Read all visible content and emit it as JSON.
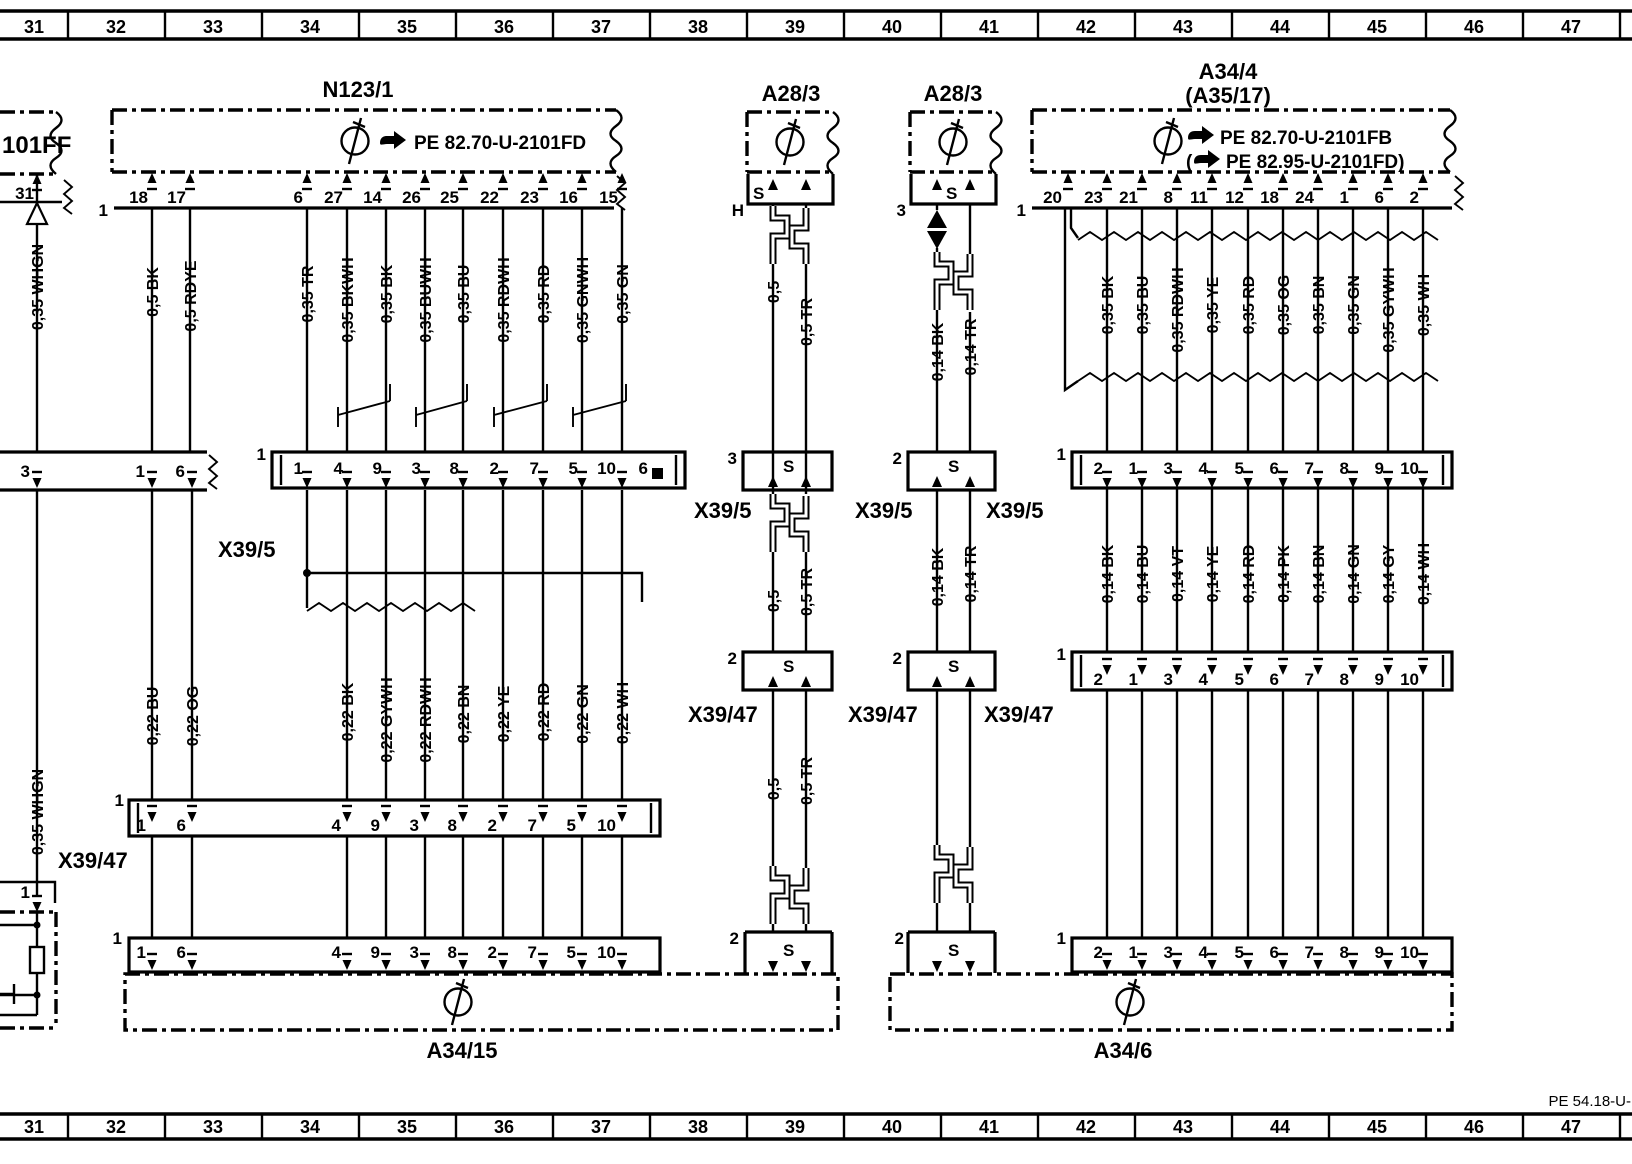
{
  "ruler": [
    "31",
    "32",
    "33",
    "34",
    "35",
    "36",
    "37",
    "38",
    "39",
    "40",
    "41",
    "42",
    "43",
    "44",
    "45",
    "46",
    "47"
  ],
  "footer": "PE 54.18-U-",
  "left": {
    "ref": "101FF",
    "pin31": "31",
    "wire_top": "0,35 WHGN",
    "strip_pins": [
      "3",
      "1",
      "6"
    ],
    "wire_bottom": "0,35 WHGN",
    "pin1": "1"
  },
  "n123": {
    "title": "N123/1",
    "ref": "PE 82.70-U-2101FD",
    "row": "1",
    "pins": [
      "18",
      "17",
      "6",
      "27",
      "14",
      "26",
      "25",
      "22",
      "23",
      "16",
      "15"
    ],
    "wires": [
      "0,5 BK",
      "0,5 RDYE",
      "0,35 TR",
      "0,35 BKWH",
      "0,35 BK",
      "0,35 BUWH",
      "0,35 BU",
      "0,35 RDWH",
      "0,35 RD",
      "0,35 GNWH",
      "0,35 GN"
    ]
  },
  "x5l": {
    "label": "X39/5",
    "row": "1",
    "pins": [
      "1",
      "4",
      "9",
      "3",
      "8",
      "2",
      "7",
      "5",
      "10",
      "6"
    ]
  },
  "w22": [
    "0,22 BU",
    "0,22 OG",
    "0,22 BK",
    "0,22 GYWH",
    "0,22 RDWH",
    "0,22 BN",
    "0,22 YE",
    "0,22 RD",
    "0,22 GN",
    "0,22 WH"
  ],
  "x47l": {
    "label": "X39/47",
    "row": "1",
    "pins": [
      "1",
      "6",
      "4",
      "9",
      "3",
      "8",
      "2",
      "7",
      "5",
      "10"
    ]
  },
  "a3415": {
    "row": "1",
    "pins": [
      "1",
      "6",
      "4",
      "9",
      "3",
      "8",
      "2",
      "7",
      "5",
      "10"
    ],
    "label": "A34/15"
  },
  "ca": {
    "title": "A28/3",
    "h": "H",
    "s": "S",
    "x5_row": "3",
    "x5": "X39/5",
    "x47_row": "2",
    "x47": "X39/47",
    "bottom_row": "2",
    "w1": [
      "0,5",
      "0,5 TR"
    ],
    "w2": [
      "0,5",
      "0,5 TR"
    ],
    "w3": [
      "0,5",
      "0,5 TR"
    ]
  },
  "cb": {
    "title": "A28/3",
    "s": "S",
    "top_row": "3",
    "x5_row": "2",
    "x5": "X39/5",
    "x47_row": "2",
    "x47": "X39/47",
    "bottom_row": "2",
    "w1": [
      "0,14 BK",
      "0,14 TR"
    ],
    "w2": [
      "0,14 BK",
      "0,14 TR"
    ]
  },
  "a344": {
    "title": "A34/4",
    "subtitle": "(A35/17)",
    "ref1": "PE 82.70-U-2101FB",
    "ref2_open": "(",
    "ref2": "PE 82.95-U-2101FD)",
    "row": "1",
    "pins": [
      "20",
      "23",
      "21",
      "8",
      "11",
      "12",
      "18",
      "24",
      "1",
      "6",
      "2"
    ],
    "wires": [
      "0,35 BK",
      "0,35 BU",
      "0,35 RDWH",
      "0,35 YE",
      "0,35 RD",
      "0,35 OG",
      "0,35 BN",
      "0,35 GN",
      "0,35 GYWH",
      "0,35 WH"
    ]
  },
  "x5r": {
    "label": "X39/5",
    "row": "1",
    "pins": [
      "2",
      "1",
      "3",
      "4",
      "5",
      "6",
      "7",
      "8",
      "9",
      "10"
    ]
  },
  "w14": [
    "0,14 BK",
    "0,14 BU",
    "0,14 VT",
    "0,14 YE",
    "0,14 RD",
    "0,14 PK",
    "0,14 BN",
    "0,14 GN",
    "0,14 GY",
    "0,14 WH"
  ],
  "x47r": {
    "label": "X39/47",
    "row": "1",
    "pins": [
      "2",
      "1",
      "3",
      "4",
      "5",
      "6",
      "7",
      "8",
      "9",
      "10"
    ]
  },
  "a346": {
    "row": "1",
    "pins": [
      "2",
      "1",
      "3",
      "4",
      "5",
      "6",
      "7",
      "8",
      "9",
      "10"
    ],
    "label": "A34/6"
  }
}
